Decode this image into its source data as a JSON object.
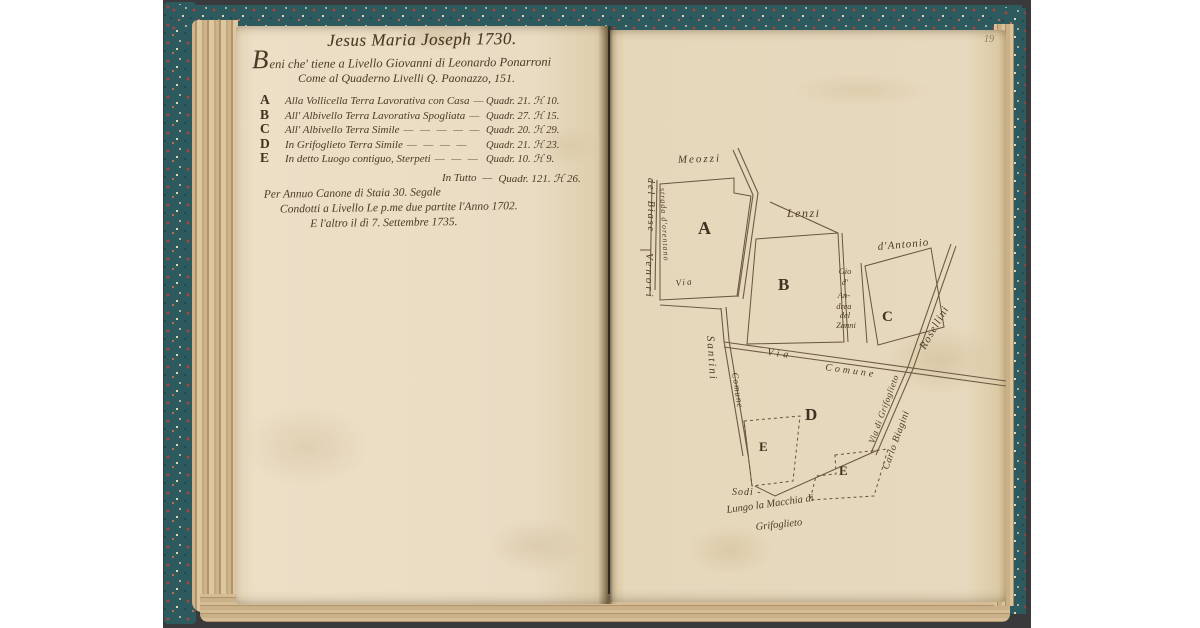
{
  "document": {
    "folio_number": "19",
    "colors": {
      "page_cream": "#e9dcc3",
      "ink_brown": "#4a3a26",
      "cover_marble_teal": "#2d5a5e",
      "backdrop_gray": "#3a393b"
    }
  },
  "left_page": {
    "title": "Jesus Maria Joseph 1730.",
    "intro_line1": "Beni che' tiene a Livello Giovanni di Leonardo Ponarroni",
    "intro_line2": "Come al Quaderno Livelli Q. Paonazzo, 151.",
    "items": [
      {
        "key": "A",
        "desc": "Alla Vollicella Terra Lavorativa con Casa",
        "dashes": "—",
        "value": "Quadr. 21. ℋ 10."
      },
      {
        "key": "B",
        "desc": "All' Albivello Terra Lavorativa Spogliata",
        "dashes": "— —",
        "value": "Quadr. 27. ℋ 15."
      },
      {
        "key": "C",
        "desc": "All' Albivello Terra Simile",
        "dashes": "— — — — —",
        "value": "Quadr. 20. ℋ 29."
      },
      {
        "key": "D",
        "desc": "In Grifoglieto Terra Simile",
        "dashes": "— — — —",
        "value": "Quadr. 21. ℋ 23."
      },
      {
        "key": "E",
        "desc": "In detto Luogo contiguo, Sterpeti",
        "dashes": "— — —",
        "value": "Quadr. 10. ℋ 9."
      }
    ],
    "total_label": "In Tutto",
    "total_dash": "—",
    "total_value": "Quadr. 121. ℋ 26.",
    "canon_line1": "Per Annuo Canone di Staia 30. Segale",
    "canon_line2": "Condotti a Livello Le p.me due partite l'Anno 1702.",
    "canon_line3": "E l'altro il dì 7. Settembre 1735."
  },
  "map": {
    "parcel_labels": {
      "a": "A",
      "b": "B",
      "c": "C",
      "d": "D",
      "e1": "E",
      "e2": "E"
    },
    "labels": {
      "meozzi": "Meozzi",
      "lenzi": "Lenzi",
      "dantonio": "d'Antonio",
      "del_biase": "del Biase",
      "venori": "Venori",
      "strada_orentano": "strada d'orentano",
      "via_small": "Via",
      "santini": "Santini",
      "comune_left": "Comune",
      "via_comune_via": "Via",
      "via_comune_comune": "Comune",
      "gio_strip": [
        "Gio",
        "d'",
        "An-",
        "drea",
        "del",
        "Zanni"
      ],
      "rosellini": "Rosellini",
      "via_grifoglieto": "Via di Grifoglieto",
      "carlo_biagini": "Carlo Biagini",
      "sodi": "Sodi -",
      "macchia_line1": "Lungo la Macchia di",
      "macchia_line2": "Grifoglieto"
    }
  }
}
